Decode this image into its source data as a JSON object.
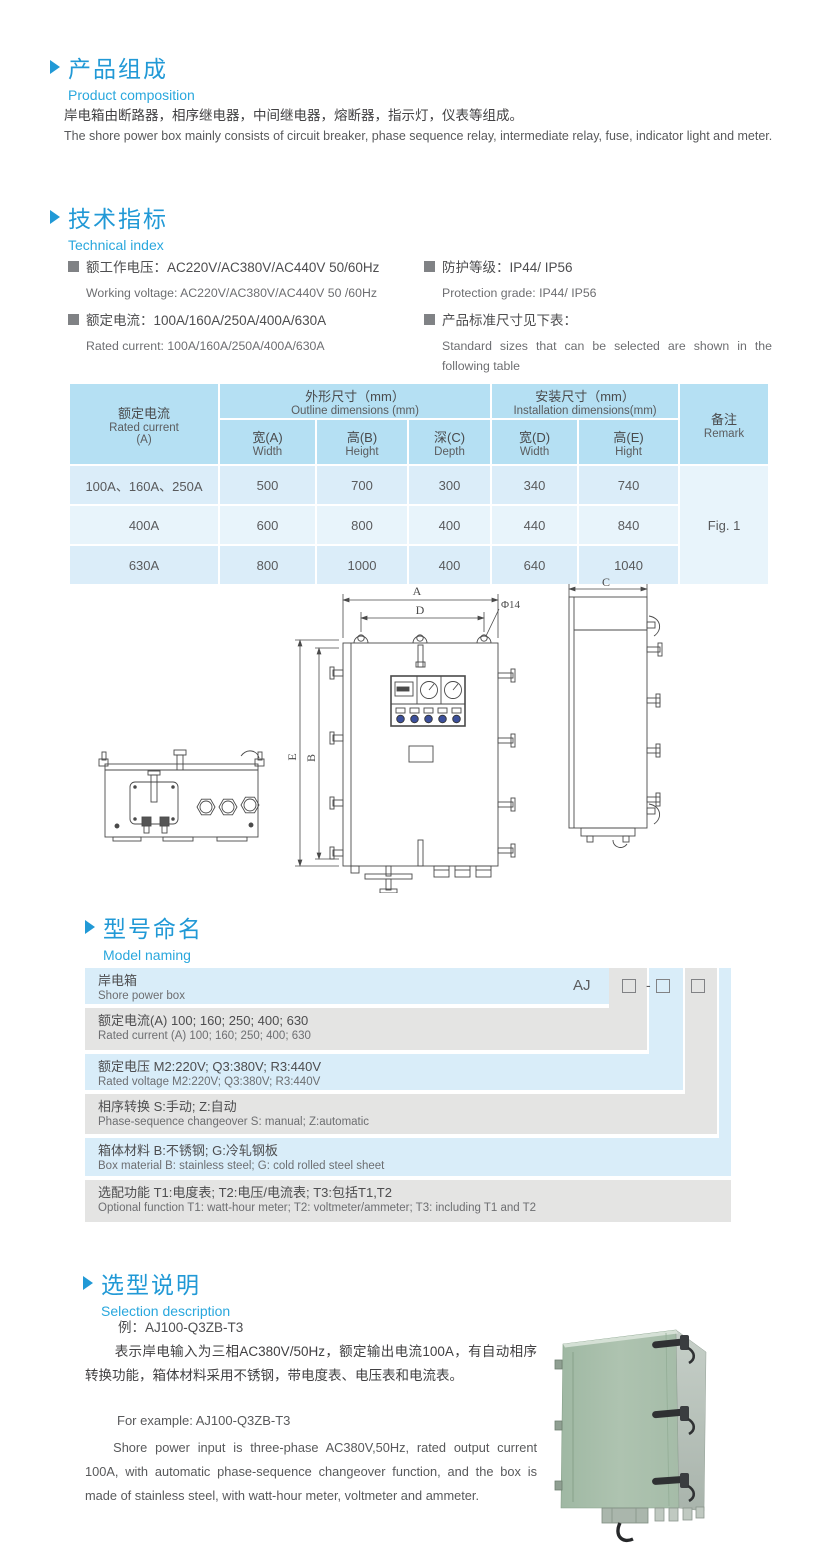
{
  "section_composition": {
    "title_cn": "产品组成",
    "title_en": "Product  composition",
    "body_cn": "岸电箱由断路器，相序继电器，中间继电器，熔断器，指示灯，仪表等组成。",
    "body_en": "The shore power box mainly consists of circuit breaker, phase sequence relay, intermediate relay, fuse, indicator light and meter."
  },
  "section_technical": {
    "title_cn": "技术指标",
    "title_en": "Technical index",
    "specs_left": [
      {
        "cn": "额工作电压：AC220V/AC380V/AC440V  50/60Hz",
        "en": "Working voltage: AC220V/AC380V/AC440V 50 /60Hz"
      },
      {
        "cn": "额定电流：100A/160A/250A/400A/630A",
        "en": "Rated current: 100A/160A/250A/400A/630A"
      }
    ],
    "specs_right": [
      {
        "cn": "防护等级：IP44/ IP56",
        "en": "Protection grade: IP44/ IP56"
      },
      {
        "cn": "产品标准尺寸见下表：",
        "en": "Standard sizes that can be selected are shown in the following table"
      }
    ]
  },
  "table": {
    "col1_header_cn": "额定电流",
    "col1_header_en": "Rated current",
    "col1_header_unit": "(A)",
    "outline_cn": "外形尺寸（mm）",
    "outline_en": "Outline dimensions (mm)",
    "install_cn": "安装尺寸（mm）",
    "install_en": "Installation dimensions(mm)",
    "remark_cn": "备注",
    "remark_en": "Remark",
    "sub_headers": [
      {
        "cn": "宽(A)",
        "en": "Width"
      },
      {
        "cn": "高(B)",
        "en": "Height"
      },
      {
        "cn": "深(C)",
        "en": "Depth"
      },
      {
        "cn": "宽(D)",
        "en": "Width"
      },
      {
        "cn": "高(E)",
        "en": "Hight"
      }
    ],
    "rows": [
      {
        "current": "100A、160A、250A",
        "w": "500",
        "h": "700",
        "d": "300",
        "iw": "340",
        "ih": "740"
      },
      {
        "current": "400A",
        "w": "600",
        "h": "800",
        "d": "400",
        "iw": "440",
        "ih": "840"
      },
      {
        "current": "630A",
        "w": "800",
        "h": "1000",
        "d": "400",
        "iw": "640",
        "ih": "1040"
      }
    ],
    "remark_value": "Fig. 1"
  },
  "drawing": {
    "dim_a": "A",
    "dim_d": "D",
    "dim_phi": "Φ14",
    "dim_e": "E",
    "dim_b": "B",
    "dim_c": "C"
  },
  "section_model": {
    "title_cn": "型号命名",
    "title_en": "Model naming",
    "prefix": "AJ",
    "dash": "-",
    "rows": [
      {
        "cn": "岸电箱",
        "en": "Shore power box"
      },
      {
        "cn": "额定电流(A)  100; 160; 250; 400; 630",
        "en": "Rated current (A) 100; 160; 250; 400; 630"
      },
      {
        "cn": "额定电压   M2:220V;  Q3:380V;  R3:440V",
        "en": "Rated voltage   M2:220V;  Q3:380V;  R3:440V"
      },
      {
        "cn": "相序转换  S:手动; Z:自动",
        "en": "Phase-sequence changeover  S: manual;  Z:automatic"
      },
      {
        "cn": "箱体材料    B:不锈钢;  G:冷轧钢板",
        "en": "Box material    B: stainless steel; G: cold rolled steel sheet"
      },
      {
        "cn": "选配功能      T1:电度表;  T2:电压/电流表; T3:包括T1,T2",
        "en": "Optional function  T1: watt-hour meter; T2: voltmeter/ammeter; T3: including T1 and T2"
      }
    ]
  },
  "section_selection": {
    "title_cn": "选型说明",
    "title_en": "Selection description",
    "example_cn": "例：AJ100-Q3ZB-T3",
    "body_cn": "表示岸电输入为三相AC380V/50Hz，额定输出电流100A，有自动相序转换功能，箱体材料采用不锈钢，带电度表、电压表和电流表。",
    "example_en": "For example: AJ100-Q3ZB-T3",
    "body_en": "Shore power input is three-phase AC380V,50Hz, rated output current 100A, with automatic phase-sequence changeover function, and the box is made of stainless steel, with watt-hour meter, voltmeter and ammeter."
  }
}
